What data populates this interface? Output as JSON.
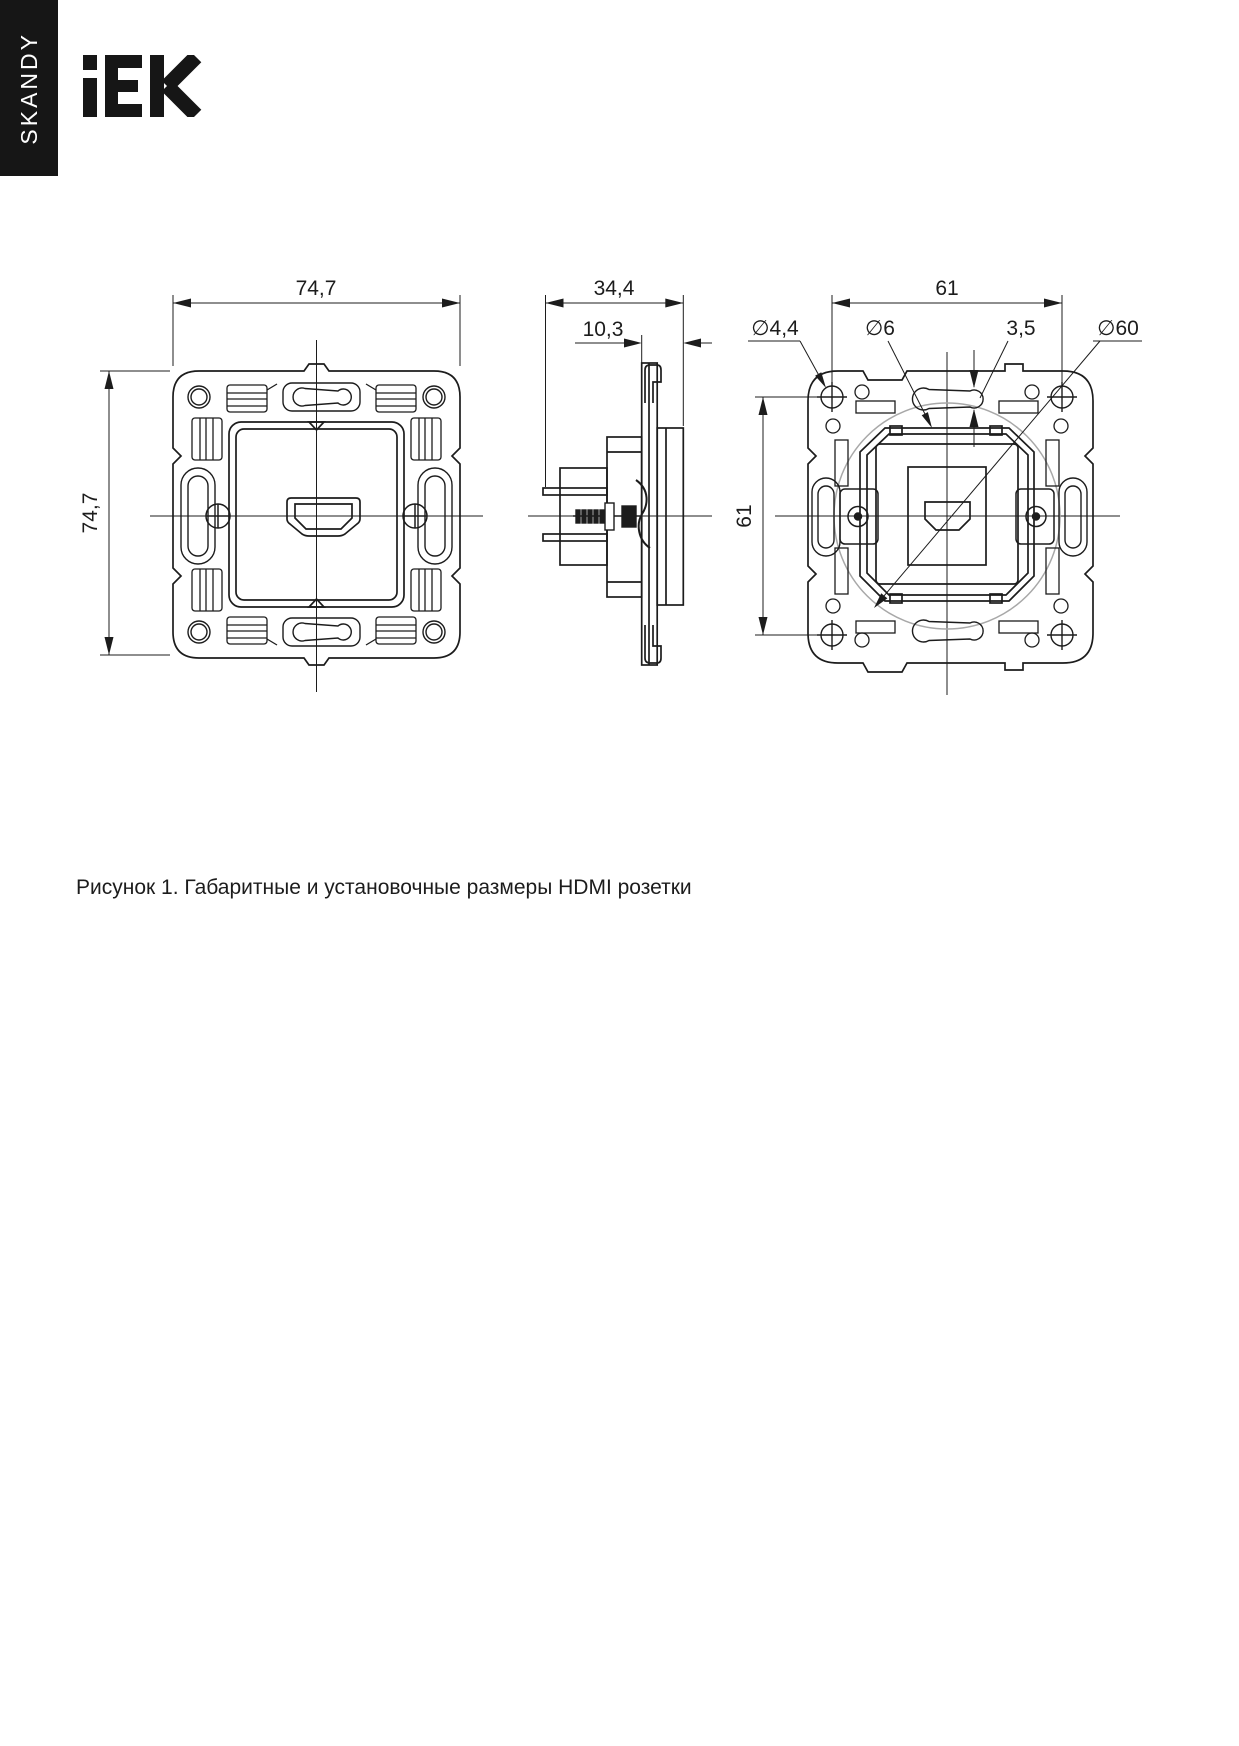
{
  "page": {
    "sidebar_label": "SKANDY",
    "brand": "IEK",
    "caption": "Рисунок 1. Габаритные и установочные размеры HDMI розетки"
  },
  "colors": {
    "background": "#ffffff",
    "line": "#1c1c1c",
    "sidebar_bg": "#161616",
    "sidebar_text": "#ffffff",
    "aux_circle": "#a8a8a8"
  },
  "figure": {
    "front_view": {
      "width": "74,7",
      "height": "74,7"
    },
    "side_view": {
      "depth": "34,4",
      "front_projection": "10,3"
    },
    "rear_view": {
      "mount_width": "61",
      "mount_height": "61",
      "screw_hole_dia": "∅4,4",
      "slot_end_dia": "∅6",
      "slot_width": "3,5",
      "install_dia": "∅60"
    }
  }
}
